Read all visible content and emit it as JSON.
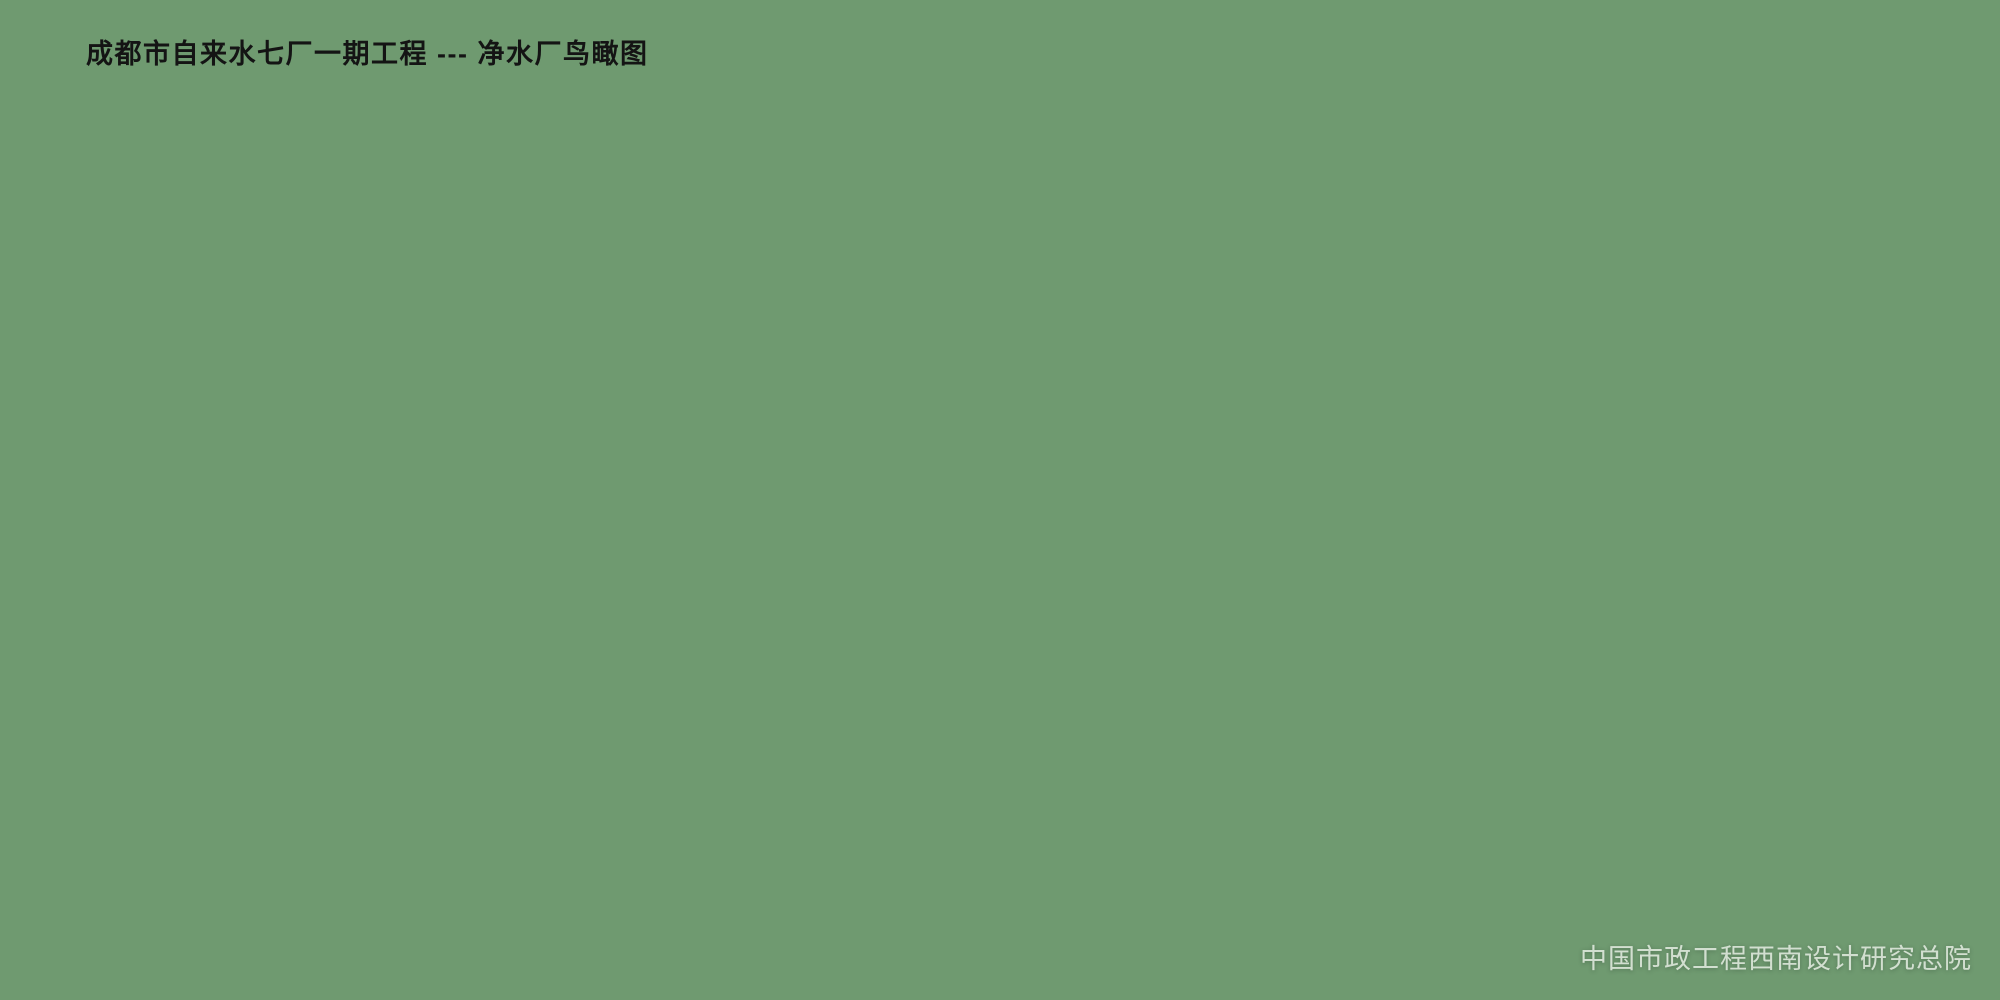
{
  "header": {
    "title": "成都市自来水七厂一期工程 --- 净水厂鸟瞰图"
  },
  "footer": {
    "credit": "中国市政工程西南设计研究总院"
  },
  "scene": {
    "type": "aerial-architectural-rendering",
    "subject": "water treatment plant bird's-eye view",
    "clarifier_count": 8,
    "vehicle_count": 5,
    "palette": {
      "water": "#3f9fd0",
      "waterLight": "#7cc7e3",
      "waterDeep": "#2f8fc0",
      "concrete": "#d6cba2",
      "rim": "#e9ddba",
      "roofCream": "#ecdfc4",
      "wallCream": "#f5eedb",
      "archRoof": "#9db1c4",
      "archLight": "#e2e9f0",
      "skylight": "#f4f8fb",
      "terracotta": "#d9a05f",
      "treeDark": "#3a6336",
      "treeMid": "#578745",
      "treeLight": "#7fae55",
      "treeYellow": "#c8a636",
      "treeOrange": "#c07a30",
      "treeRed": "#a84f2e",
      "ground": "#8fb06c",
      "groundNE": "#9db672",
      "groundBasin": "#b2c086",
      "lawn": "#96ad5e",
      "road": "#cdd2bd",
      "path": "#e9e7db",
      "highway": "#a0a8a3",
      "highwayEdge": "#d8d9cf",
      "yellowLine": "#d2b23c",
      "white": "#f1f2ee",
      "shadow": "#27422c",
      "flower1": "#bf6b3a",
      "flower2": "#d9a84a",
      "courtPink": "#e4a894"
    }
  }
}
